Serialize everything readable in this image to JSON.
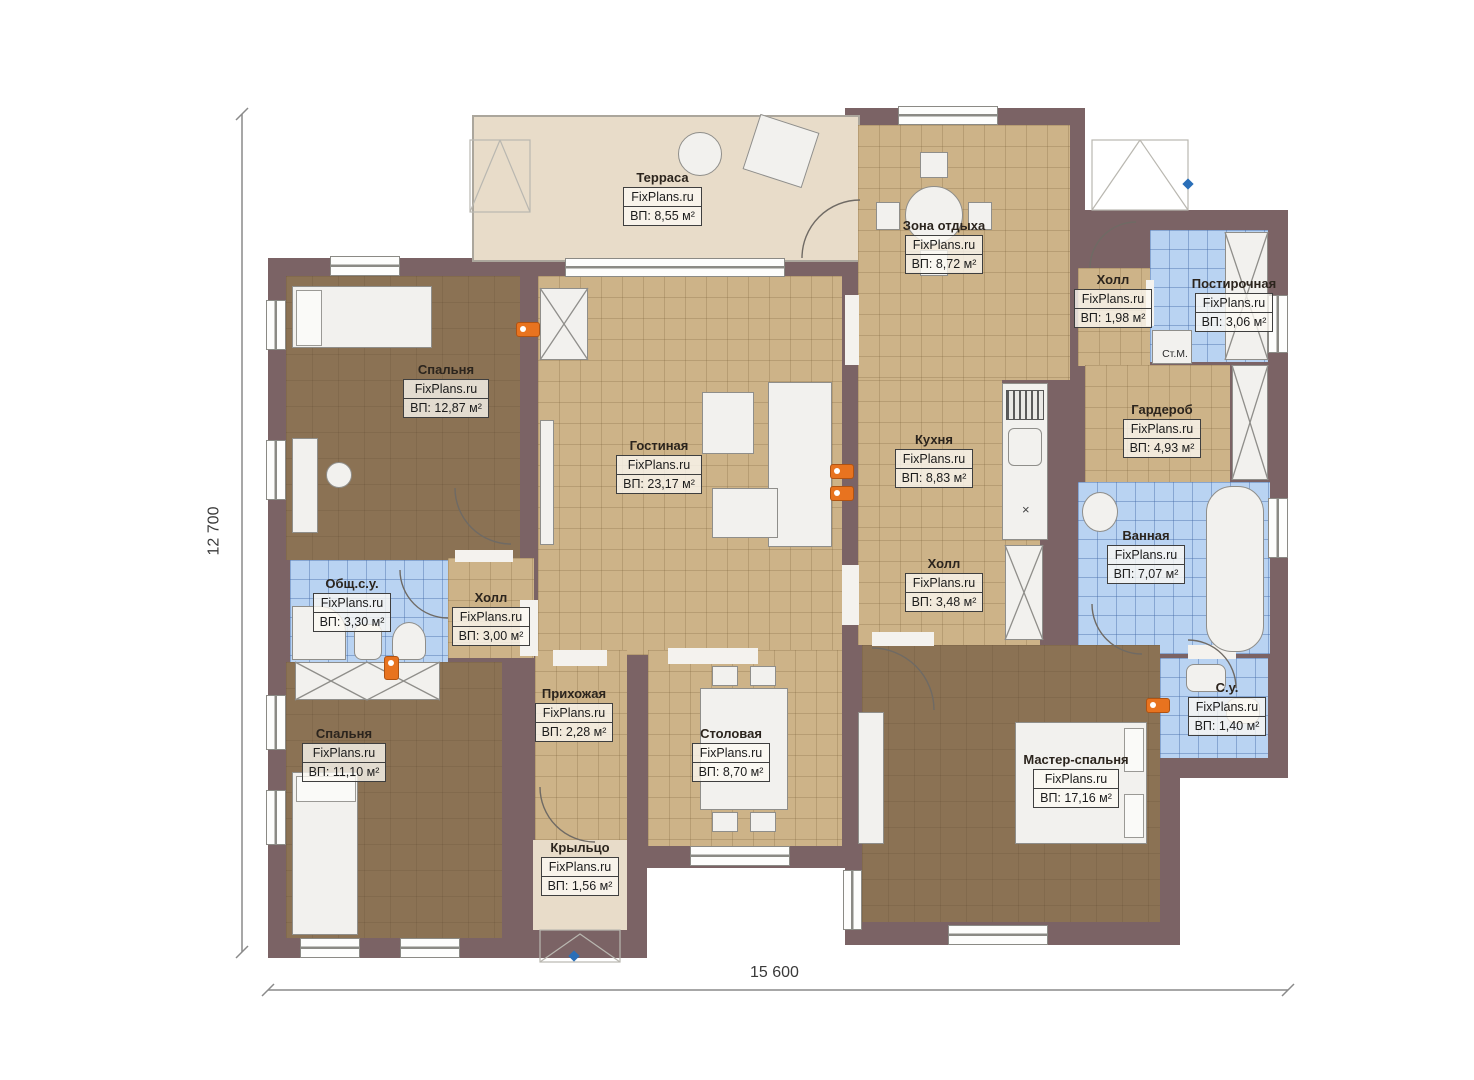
{
  "meta": {
    "watermark": "FixPlans.ru"
  },
  "dimensions": {
    "height": "12 700",
    "width": "15 600"
  },
  "rooms": [
    {
      "id": "terrace",
      "name": "Терраса",
      "area": "ВП: 8,55 м²"
    },
    {
      "id": "lounge",
      "name": "Зона отдыха",
      "area": "ВП: 8,72 м²"
    },
    {
      "id": "hall-top",
      "name": "Холл",
      "area": "ВП: 1,98 м²"
    },
    {
      "id": "laundry",
      "name": "Постирочная",
      "area": "ВП: 3,06 м²"
    },
    {
      "id": "bedroom-1",
      "name": "Спальня",
      "area": "ВП: 12,87 м²"
    },
    {
      "id": "living",
      "name": "Гостиная",
      "area": "ВП: 23,17 м²"
    },
    {
      "id": "kitchen",
      "name": "Кухня",
      "area": "ВП: 8,83 м²"
    },
    {
      "id": "wardrobe",
      "name": "Гардероб",
      "area": "ВП: 4,93 м²"
    },
    {
      "id": "bathroom",
      "name": "Ванная",
      "area": "ВП: 7,07 м²"
    },
    {
      "id": "shared-wc",
      "name": "Общ.с.у.",
      "area": "ВП: 3,30 м²"
    },
    {
      "id": "hall-left",
      "name": "Холл",
      "area": "ВП: 3,00 м²"
    },
    {
      "id": "hall-mid",
      "name": "Холл",
      "area": "ВП: 3,48 м²"
    },
    {
      "id": "bedroom-2",
      "name": "Спальня",
      "area": "ВП: 11,10 м²"
    },
    {
      "id": "entry",
      "name": "Прихожая",
      "area": "ВП: 2,28 м²"
    },
    {
      "id": "dining",
      "name": "Столовая",
      "area": "ВП: 8,70 м²"
    },
    {
      "id": "master",
      "name": "Мастер-спальня",
      "area": "ВП: 17,16 м²"
    },
    {
      "id": "wc",
      "name": "С.у.",
      "area": "ВП: 1,40 м²"
    },
    {
      "id": "porch",
      "name": "Крыльцо",
      "area": "ВП: 1,56 м²"
    }
  ],
  "labels": {
    "washing_machine": "Ст.М.",
    "kitchen_mark": "×"
  },
  "colors": {
    "wall": "#7b6365",
    "tile_tan": "#cdb388",
    "tile_blue": "#b9d3f2",
    "floor_brown": "#8b7254",
    "terrace": "#e8dcc9",
    "radiator_orange": "#e8731f",
    "marker_blue": "#2a6fb8"
  }
}
